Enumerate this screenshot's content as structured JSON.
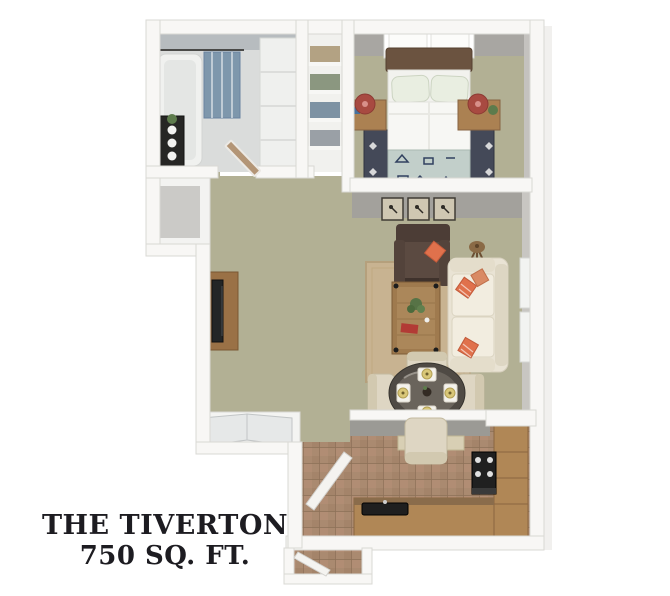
{
  "title": {
    "line1": "THE TIVERTON",
    "line2": "750 SQ. FT."
  },
  "colors": {
    "background": "#ffffff",
    "wall": "#f8f7f5",
    "wall_edge": "#d9d8d4",
    "wall_face_gray": "#a3a19c",
    "carpet": "#b2b094",
    "bath_floor": "#dadcdb",
    "kitchen_tile": "#aa8a70",
    "tile_grout": "#8d7158",
    "rug_tan": "#c8b391",
    "bed_rug_dark": "#444958",
    "sofa_cream": "#e9e3d4",
    "armchair_brown": "#4c3d36",
    "accent_orange": "#e0714c",
    "wood": "#ab8152",
    "counter_wood": "#b08756",
    "lamp_red": "#a84a41",
    "curtain_blue": "#7e97ac",
    "blanket_blue": "#c2cfca",
    "dining_chair_cream": "#ded6c3",
    "dining_table_dark": "#4f4a44",
    "title_text": "#1d1c21"
  },
  "rooms": {
    "bathroom": [
      "bathtub",
      "shower-curtain",
      "curtain-rod",
      "storage-shelf",
      "tall-cabinet"
    ],
    "linen_closet": [
      "towel-shelves"
    ],
    "bedroom": [
      "window",
      "bed",
      "pillows",
      "patterned-blanket",
      "foot-bench",
      "area-rug",
      "nightstand-left",
      "nightstand-right",
      "table-lamps"
    ],
    "living_room": [
      "wall-art-frames",
      "armchair",
      "floor-lamp",
      "area-rug",
      "coffee-table",
      "sofa",
      "throw-pillows",
      "tv-console",
      "windows"
    ],
    "dining_area": [
      "round-table",
      "placemats",
      "dining-chairs"
    ],
    "kitchen": [
      "breakfast-bar",
      "pass-through-shelf",
      "range",
      "sink",
      "counters",
      "tile-floor"
    ],
    "entry": [
      "front-door",
      "interior-door",
      "sliding-closet-doors"
    ]
  }
}
